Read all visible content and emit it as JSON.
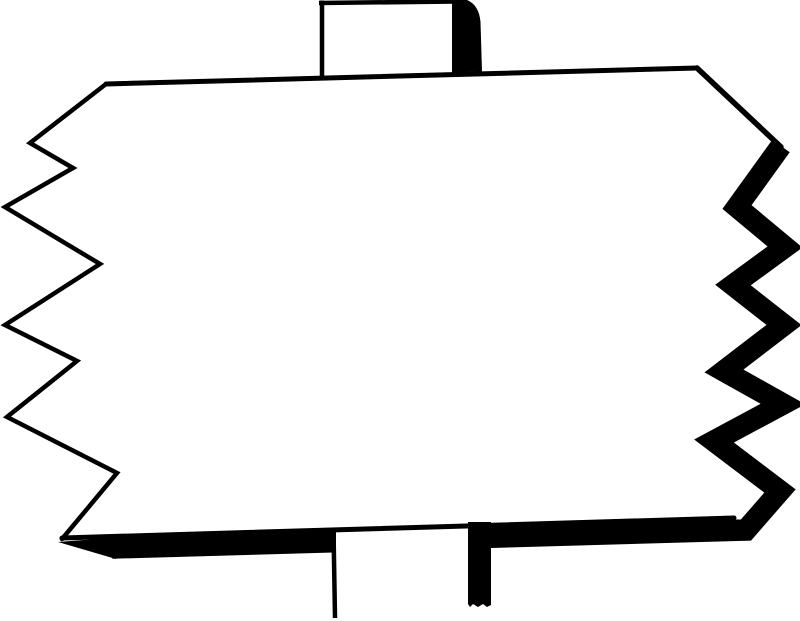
{
  "figure": {
    "title": "Blank wooden sign",
    "description": "Black-and-white clip-art drawing of a blank rectangular signboard with jagged zig-zag torn left and right edges, nailed to a vertical post that pokes out above the top edge and continues below the bottom edge. The right edge and bottom edge carry heavy black ink shadow; the left edge and top edge are thin lines. The board itself is empty white.",
    "board_text": "",
    "style": "woodcut clip art, solid black ink on white paper",
    "elements": {
      "board": "blank sign board",
      "top_edge": "thin top edge line",
      "left_edge": "thin zig-zag torn left edge",
      "right_edge": "thick ink-shadow zig-zag torn right edge",
      "bottom_edge": "thick ink-shadow bottom band tapering to a point at the left",
      "top_post": "post stub above the board with black shadow on its right side",
      "bottom_post": "post below the board, white with thin left outline and thick black shadow bar on its right side"
    }
  },
  "colors": {
    "ink": "#000000",
    "paper": "#ffffff"
  }
}
